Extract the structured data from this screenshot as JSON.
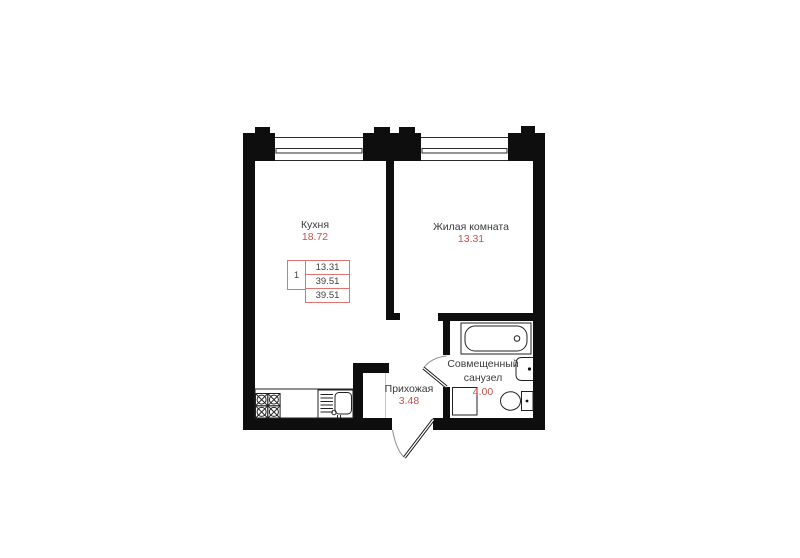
{
  "plan": {
    "rooms": {
      "kitchen": {
        "name": "Кухня",
        "area": "18.72"
      },
      "living": {
        "name": "Жилая комната",
        "area": "13.31"
      },
      "hallway": {
        "name": "Прихожая",
        "area": "3.48"
      },
      "bathroom": {
        "name_line1": "Совмещенный",
        "name_line2": "санузел",
        "area": "4.00"
      }
    },
    "stamp": {
      "rooms": "1",
      "living_area": "13.31",
      "area": "39.51",
      "total_area": "39.51"
    },
    "colors": {
      "wall": "#0e0e0e",
      "accent": "#c4524e",
      "legend": "#de7370",
      "ink": "#3b3b3b"
    }
  }
}
